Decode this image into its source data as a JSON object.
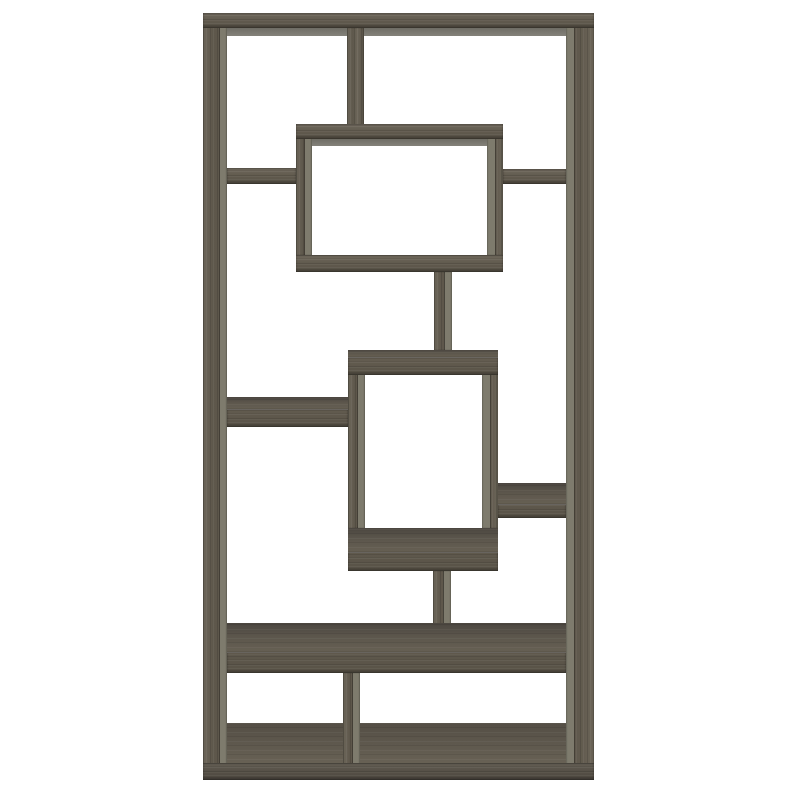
{
  "subject": "Product photo of an asymmetrical geometric 10-shelf cube bookcase in weathered grey wood on a white background",
  "canvas": {
    "width": 800,
    "height": 800
  },
  "palette": {
    "background": "#ffffff",
    "wood_front": "#665f52",
    "wood_front_dark": "#5a544a",
    "wood_side_light": "#7e7b6d",
    "wood_top_face": "#5c564c",
    "seam_shadow": "#403c35"
  },
  "boards": [
    {
      "name": "top-board-underside",
      "x": 227,
      "y": 28,
      "w": 339,
      "h": 8,
      "kind": "underside"
    },
    {
      "name": "upper-box-top-underside",
      "x": 312,
      "y": 139,
      "w": 175,
      "h": 7,
      "kind": "underside"
    },
    {
      "name": "left-post",
      "x": 203,
      "y": 13,
      "w": 24,
      "h": 752,
      "kind": "v",
      "side": "right"
    },
    {
      "name": "right-post",
      "x": 566,
      "y": 13,
      "w": 28,
      "h": 752,
      "kind": "v",
      "side": "left"
    },
    {
      "name": "top-board",
      "x": 203,
      "y": 13,
      "w": 391,
      "h": 15,
      "kind": "h"
    },
    {
      "name": "top-center-divider",
      "x": 347,
      "y": 28,
      "w": 17,
      "h": 97,
      "kind": "v"
    },
    {
      "name": "upper-box-left-wall",
      "x": 296,
      "y": 138,
      "w": 16,
      "h": 117,
      "kind": "v",
      "side": "right"
    },
    {
      "name": "upper-box-right-wall",
      "x": 487,
      "y": 138,
      "w": 16,
      "h": 117,
      "kind": "v",
      "side": "left"
    },
    {
      "name": "upper-box-top-board",
      "x": 296,
      "y": 124,
      "w": 207,
      "h": 15,
      "kind": "h"
    },
    {
      "name": "upper-box-bottom-board",
      "x": 296,
      "y": 255,
      "w": 207,
      "h": 17,
      "kind": "h"
    },
    {
      "name": "upper-left-shelf",
      "x": 227,
      "y": 168,
      "w": 69,
      "h": 16,
      "kind": "h"
    },
    {
      "name": "upper-right-shelf",
      "x": 503,
      "y": 169,
      "w": 63,
      "h": 15,
      "kind": "h"
    },
    {
      "name": "upper-middle-connector",
      "x": 434,
      "y": 272,
      "w": 18,
      "h": 78,
      "kind": "v",
      "side": "right"
    },
    {
      "name": "middle-box-left-wall",
      "x": 348,
      "y": 372,
      "w": 17,
      "h": 156,
      "kind": "v",
      "side": "right"
    },
    {
      "name": "middle-box-right-wall",
      "x": 482,
      "y": 372,
      "w": 16,
      "h": 156,
      "kind": "v",
      "side": "left"
    },
    {
      "name": "middle-box-top-board",
      "x": 348,
      "y": 350,
      "w": 150,
      "h": 25,
      "kind": "h",
      "top_face": 8
    },
    {
      "name": "middle-box-bottom-board",
      "x": 348,
      "y": 528,
      "w": 150,
      "h": 43,
      "kind": "h",
      "top_face": 25
    },
    {
      "name": "left-long-shelf",
      "x": 227,
      "y": 397,
      "w": 121,
      "h": 30,
      "kind": "h",
      "top_face": 13
    },
    {
      "name": "right-small-shelf",
      "x": 498,
      "y": 483,
      "w": 68,
      "h": 35,
      "kind": "h",
      "top_face": 22
    },
    {
      "name": "lower-middle-connector",
      "x": 433,
      "y": 571,
      "w": 18,
      "h": 54,
      "kind": "v",
      "side": "right"
    },
    {
      "name": "wide-lower-shelf",
      "x": 227,
      "y": 623,
      "w": 339,
      "h": 50,
      "kind": "h",
      "top_face": 30
    },
    {
      "name": "base-interior-floor",
      "x": 227,
      "y": 723,
      "w": 339,
      "h": 41,
      "kind": "floor"
    },
    {
      "name": "bottom-divider",
      "x": 343,
      "y": 673,
      "w": 17,
      "h": 91,
      "kind": "v",
      "side": "right"
    },
    {
      "name": "base-front-board",
      "x": 203,
      "y": 763,
      "w": 391,
      "h": 17,
      "kind": "h",
      "dark": true
    }
  ]
}
